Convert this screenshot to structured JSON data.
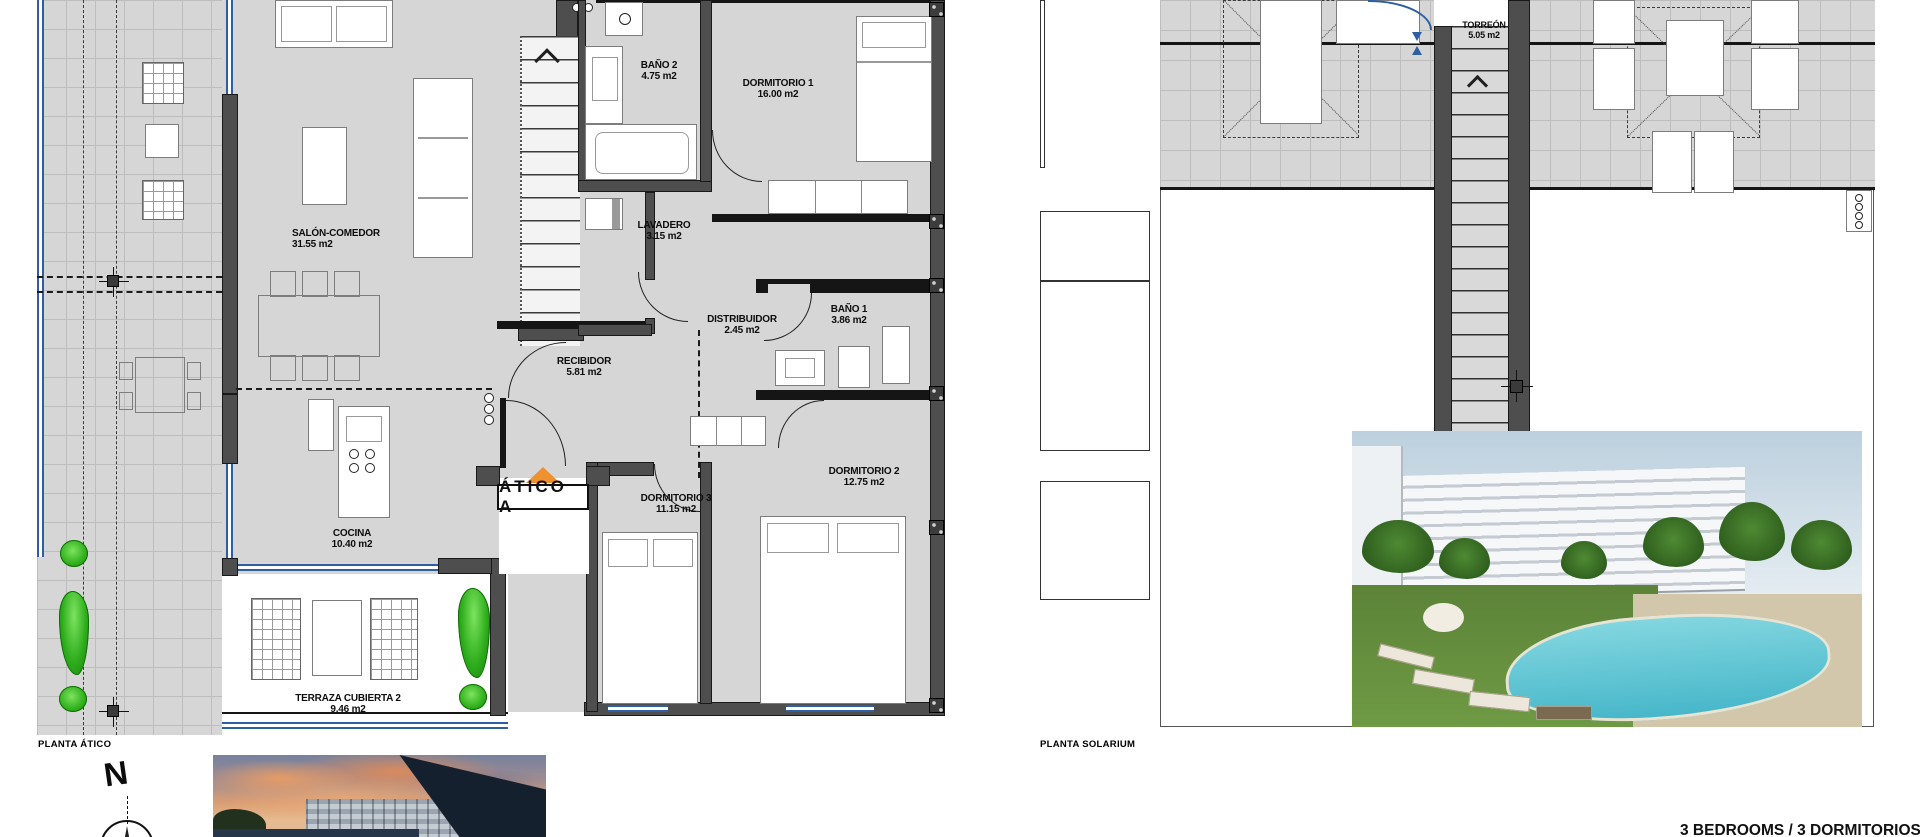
{
  "colors": {
    "plan_fill": "#d6d6d6",
    "tile_line": "#bdbdbd",
    "wall_dark": "#4e4e4e",
    "glass_blue": "#2e5fa3",
    "plant_green": "#35b31f",
    "accent_orange": "#ef9130"
  },
  "atico": {
    "title": "PLANTA ÁTICO",
    "unit_label": "ÁTICO A",
    "rooms": [
      {
        "name": "SALÓN-COMEDOR",
        "area": "31.55 m2"
      },
      {
        "name": "BAÑO 2",
        "area": "4.75 m2"
      },
      {
        "name": "DORMITORIO 1",
        "area": "16.00 m2"
      },
      {
        "name": "LAVADERO",
        "area": "3.15 m2"
      },
      {
        "name": "DISTRIBUIDOR",
        "area": "2.45 m2"
      },
      {
        "name": "BAÑO 1",
        "area": "3.86 m2"
      },
      {
        "name": "RECIBIDOR",
        "area": "5.81 m2"
      },
      {
        "name": "DORMITORIO 3",
        "area": "11.15 m2"
      },
      {
        "name": "DORMITORIO 2",
        "area": "12.75 m2"
      },
      {
        "name": "COCINA",
        "area": "10.40 m2"
      },
      {
        "name": "TERRAZA CUBIERTA 2",
        "area": "9.46 m2"
      }
    ]
  },
  "solarium": {
    "title": "PLANTA SOLARIUM",
    "rooms": [
      {
        "name": "TORREÓN",
        "area": "5.05 m2"
      }
    ]
  },
  "compass": {
    "north_label": "N"
  },
  "caption": "3 BEDROOMS / 3 DORMITORIOS"
}
